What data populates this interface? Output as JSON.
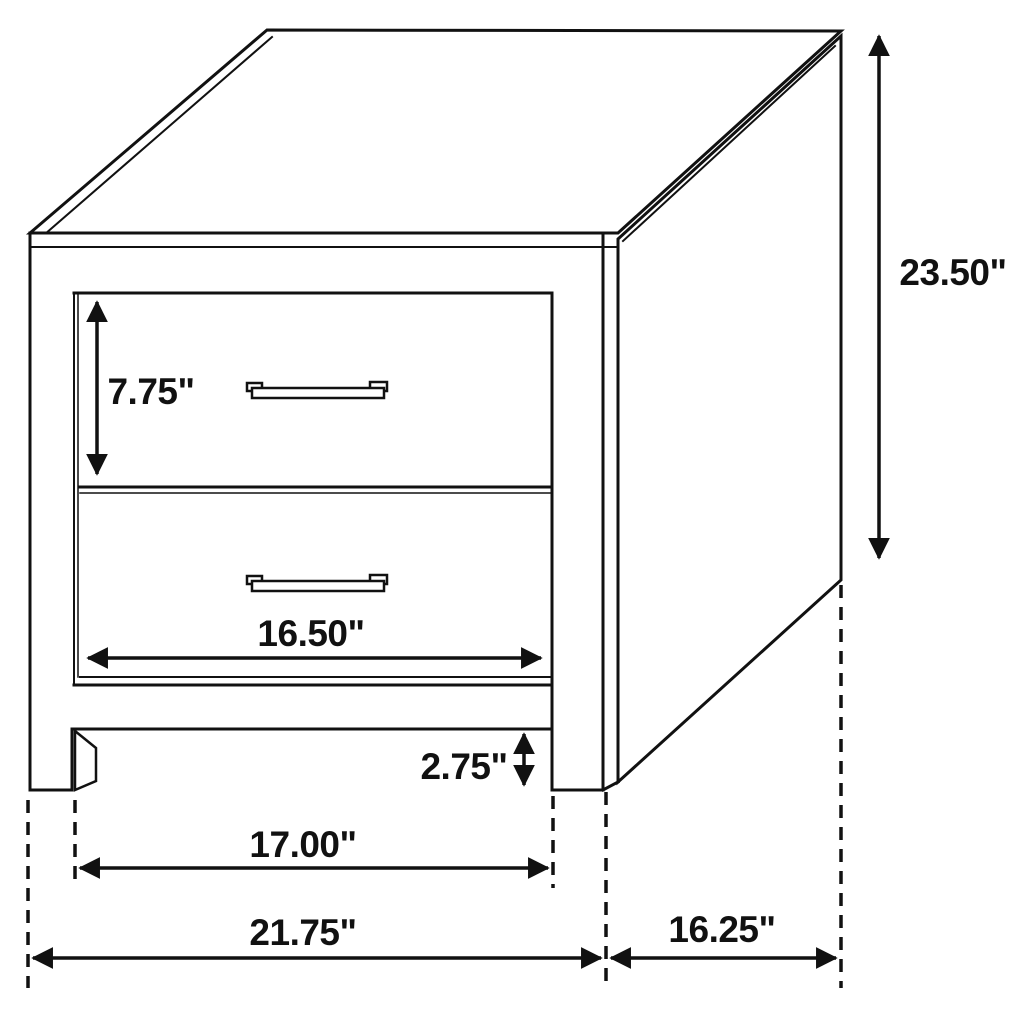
{
  "diagram": {
    "subject": "two-drawer nightstand dimension drawing",
    "colors": {
      "line": "#111111",
      "background": "#ffffff"
    }
  },
  "dimensions": {
    "overall_height": "23.50\"",
    "top_drawer_height": "7.75\"",
    "drawer_width": "16.50\"",
    "leg_clearance": "2.75\"",
    "between_legs_width": "17.00\"",
    "overall_width": "21.75\"",
    "depth": "16.25\""
  }
}
